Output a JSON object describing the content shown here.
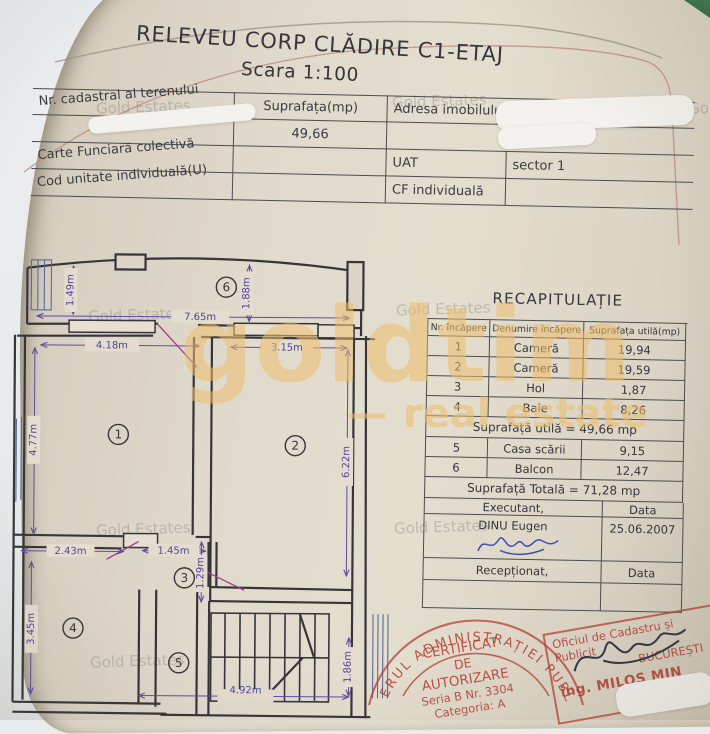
{
  "document": {
    "title": "RELEVEU CORP CLĂDIRE C1-ETAJ",
    "scale": "Scara 1:100"
  },
  "info_table": {
    "rows_left": [
      "Nr. cadastral al terenului",
      "Carte Funciară colectivă",
      "Cod unitate individuală(U)"
    ],
    "suprafata_header": "Suprafața(mp)",
    "suprafata_value": "49,66",
    "adresa_label": "Adresa imobilului",
    "uat_label": "UAT",
    "uat_value": "sector 1",
    "cf_label": "CF individuală"
  },
  "recap": {
    "title": "RECAPITULAȚIE",
    "headers": [
      "Nr. încăpere",
      "Denumire încăpere",
      "Suprafața utilă(mp)"
    ],
    "rows": [
      {
        "nr": "1",
        "name": "Cameră",
        "area": "19,94"
      },
      {
        "nr": "2",
        "name": "Cameră",
        "area": "19,59"
      },
      {
        "nr": "3",
        "name": "Hol",
        "area": "1,87"
      },
      {
        "nr": "4",
        "name": "Baie",
        "area": "8,26"
      }
    ],
    "subtotal": "Suprafață utilă = 49,66 mp",
    "rows2": [
      {
        "nr": "5",
        "name": "Casa scării",
        "area": "9,15"
      },
      {
        "nr": "6",
        "name": "Balcon",
        "area": "12,47"
      }
    ],
    "total": "Suprafață Totală = 71,28 mp",
    "executant_label": "Executant,",
    "data_label": "Data",
    "executant_name": "DINU Eugen",
    "date": "25.06.2007",
    "receptionat_label": "Recepționat,",
    "data_label2": "Data"
  },
  "plan": {
    "dims": {
      "d149": "1.49m",
      "d188": "1.88m",
      "d765": "7.65m",
      "d418": "4.18m",
      "d315": "3.15m",
      "d477": "4.77m",
      "d622": "6.22m",
      "d243": "2.43m",
      "d145": "1.45m",
      "d129": "1.29m",
      "d345": "3.45m",
      "d492": "4.92m",
      "d186": "1.86m"
    },
    "rooms": {
      "r1": "1",
      "r2": "2",
      "r3": "3",
      "r4": "4",
      "r5": "5",
      "r6": "6"
    }
  },
  "stamps": {
    "round": {
      "ring": "ERUL ADMINISTRAȚIEI PUBL",
      "line1": "CERTIFICAT",
      "line2": "DE",
      "line3": "AUTORIZARE",
      "line4": "Seria B Nr. 3304",
      "line5": "Categoria: A"
    },
    "rect": {
      "line1": "Oficiul de Cadastru și Publicit",
      "line2": "BUCUREȘTI",
      "line3": "ing. MILOS MIN",
      "line4": "consilier"
    }
  },
  "watermarks": {
    "tile": "Gold Estates",
    "brand_main": "goldtim",
    "brand_dash": "—",
    "brand_sub": "real estate"
  }
}
